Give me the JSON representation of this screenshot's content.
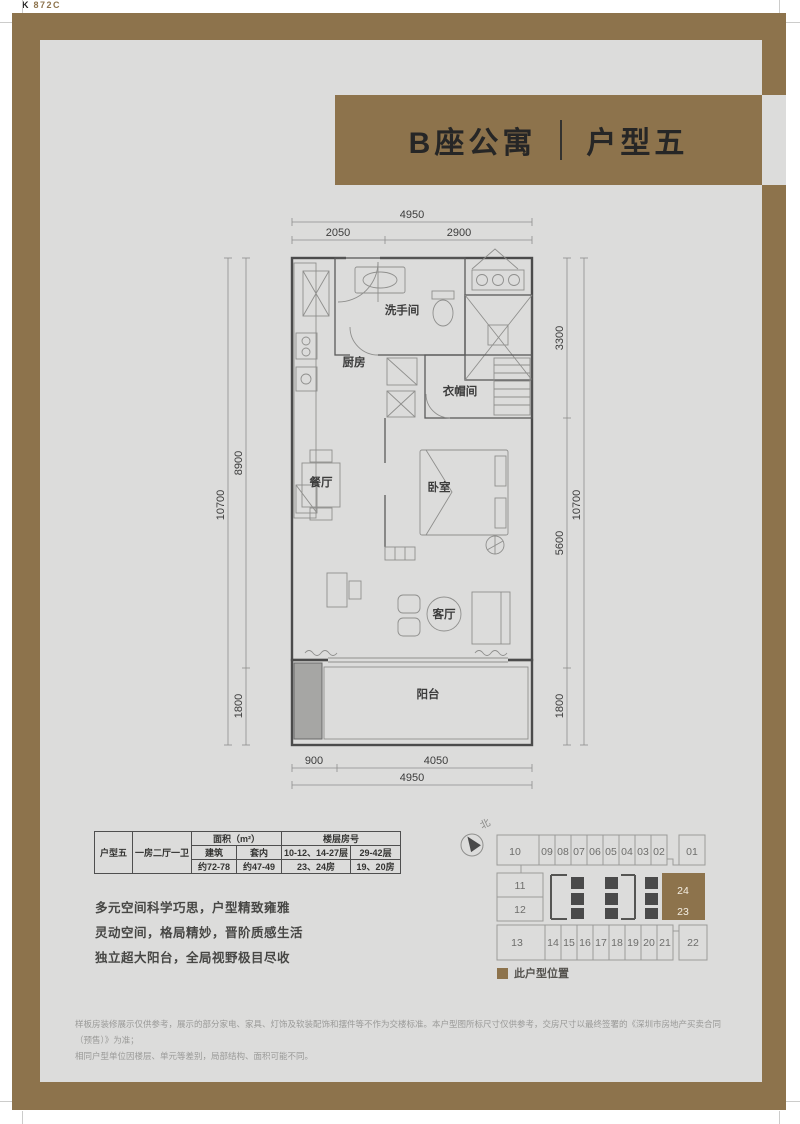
{
  "page": {
    "corner_k": "K",
    "corner_num": "872C"
  },
  "banner": {
    "building": "B座公寓",
    "unit": "户型五"
  },
  "plan": {
    "rooms": {
      "kitchen": "厨房",
      "bath": "洗手间",
      "closet": "衣帽间",
      "dining": "餐厅",
      "bedroom": "卧室",
      "living": "客厅",
      "balcony": "阳台"
    },
    "dims": {
      "top_total": "4950",
      "top_left": "2050",
      "top_right": "2900",
      "bottom_left": "900",
      "bottom_right": "4050",
      "bottom_total": "4950",
      "left_outer": "10700",
      "left_upper": "8900",
      "left_lower": "1800",
      "right_top": "3300",
      "right_mid": "5600",
      "right_bottom": "1800",
      "right_outer": "10700"
    }
  },
  "table": {
    "unit_name": "户型五",
    "layout": "一房二厅一卫",
    "area_header": "面积（m²）",
    "floor_header": "楼层房号",
    "area_sub1": "建筑",
    "area_sub2": "套内",
    "floor_sub1": "10-12、14-27层",
    "floor_sub2": "29-42层",
    "area_val1": "约72-78",
    "area_val2": "约47-49",
    "floor_val1": "23、24房",
    "floor_val2": "19、20房"
  },
  "features": {
    "line1": "多元空间科学巧思，户型精致雍雅",
    "line2": "灵动空间，格局精妙，晋阶质感生活",
    "line3": "独立超大阳台，全局视野极目尽收"
  },
  "locator": {
    "north": "北",
    "top_row": [
      "10",
      "09",
      "08",
      "07",
      "06",
      "05",
      "04",
      "03",
      "02",
      "01"
    ],
    "mid_left": [
      "11",
      "12"
    ],
    "highlight": [
      "24",
      "23"
    ],
    "bottom_row": [
      "13",
      "14",
      "15",
      "16",
      "17",
      "18",
      "19",
      "20",
      "21",
      "22"
    ],
    "legend": "此户型位置"
  },
  "disclaimer": {
    "line1": "样板房装修展示仅供参考，展示的部分家电、家具、灯饰及软装配饰和摆件等不作为交楼标准。本户型图所标尺寸仅供参考，交房尺寸以最终签署的《深圳市房地产买卖合同（预售）》为准；",
    "line2": "相同户型单位因楼层、单元等差别，局部结构、面积可能不同。"
  },
  "colors": {
    "frame": "#8d734c",
    "panel": "#dcdcdb",
    "highlight": "#8d734c"
  }
}
